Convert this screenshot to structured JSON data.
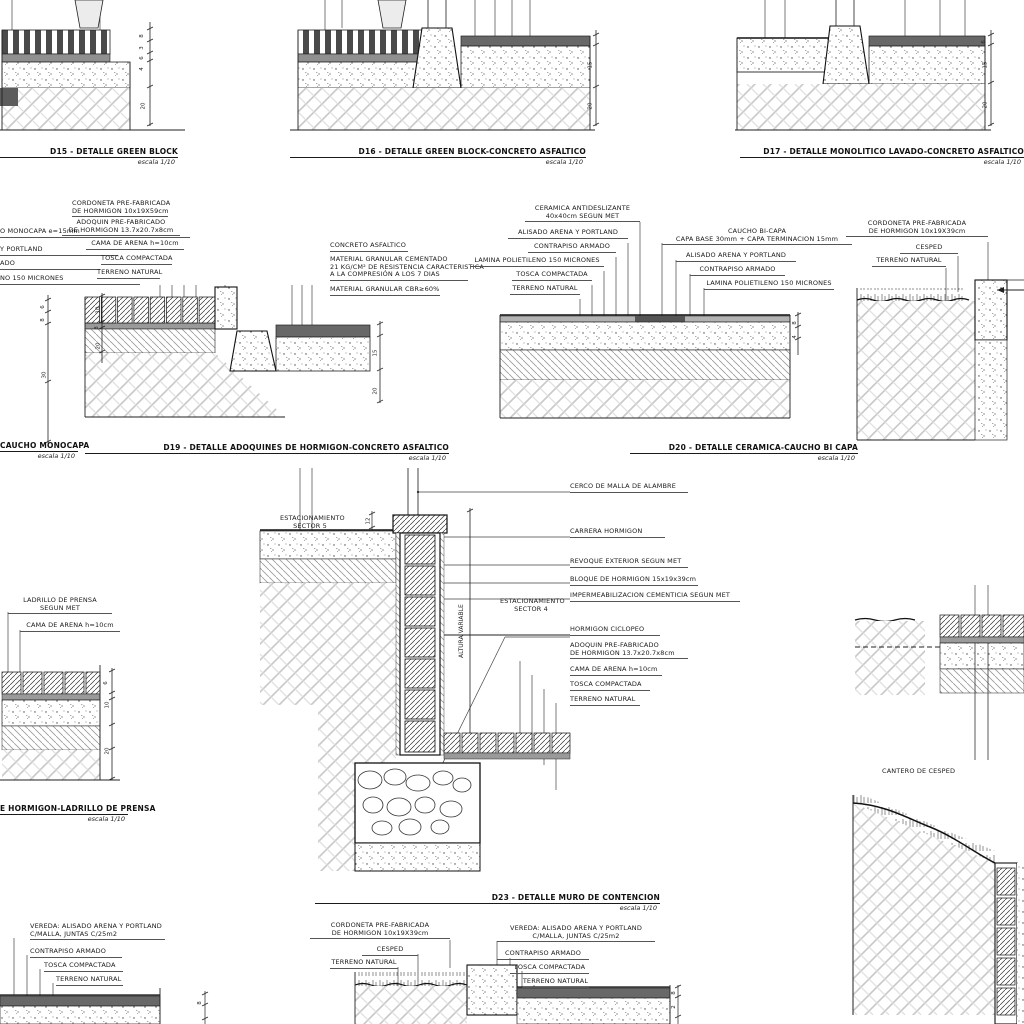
{
  "sheet": {
    "background": "#ffffff",
    "ink": "#1a1a1a"
  },
  "titles": {
    "d15": {
      "label": "D15 - DETALLE GREEN BLOCK",
      "scale": "escala 1/10"
    },
    "d16": {
      "label": "D16 - DETALLE GREEN BLOCK-CONCRETO ASFALTICO",
      "scale": "escala 1/10"
    },
    "d17": {
      "label": "D17 - DETALLE MONOLITICO LAVADO-CONCRETO ASFALTICO",
      "scale": "escala 1/10"
    },
    "d18_fragment": {
      "label": "CAUCHO MONOCAPA",
      "scale": "escala 1/10"
    },
    "d19": {
      "label": "D19 - DETALLE ADOQUINES DE HORMIGON-CONCRETO ASFALTICO",
      "scale": "escala 1/10"
    },
    "d20": {
      "label": "D20 - DETALLE CERAMICA-CAUCHO BI CAPA",
      "scale": "escala 1/10"
    },
    "d21_fragment": {
      "label": "E HORMIGON-LADRILLO DE PRENSA",
      "scale": "escala 1/10"
    },
    "d23": {
      "label": "D23 - DETALLE MURO DE CONTENCION",
      "scale": "escala 1/10"
    }
  },
  "d18": {
    "l1": "O MONOCAPA e=15mm",
    "l2": "Y PORTLAND",
    "l3": "ADO",
    "l4": "NO 150 MICRONES",
    "dim1": "6",
    "dim2": "8",
    "dim3": "30"
  },
  "d19": {
    "cordoneta1": "CORDONETA PRE-FABRICADA",
    "cordoneta2": "DE HORMIGON 10x19X59cm",
    "adoquin1": "ADOQUIN PRE-FABRICADO",
    "adoquin2": "DE HORMIGON 13.7x20.7x8cm",
    "cama": "CAMA DE ARENA h=10cm",
    "tosca": "TOSCA COMPACTADA",
    "terreno": "TERRENO NATURAL",
    "concreto": "CONCRETO ASFALTICO",
    "granular1": "MATERIAL GRANULAR CEMENTADO",
    "granular2": "21 KG/CM² DE RESISTENCIA CARACTERISTICA",
    "granular3": "A LA COMPRESIÓN A LOS 7 DIAS",
    "granular4": "MATERIAL GRANULAR CBR≥60%",
    "dimL1": "10",
    "dimL2": "8",
    "dimL3": "20",
    "dimR1": "15",
    "dimR2": "20"
  },
  "d20": {
    "ceramica1": "CERAMICA ANTIDESLIZANTE",
    "ceramica2": "40x40cm SEGUN MET",
    "alisado_izq": "ALISADO ARENA Y PORTLAND",
    "contrapiso_izq": "CONTRAPISO ARMADO",
    "lamina_izq": "LAMINA POLIETILENO 150 MICRONES",
    "tosca": "TOSCA COMPACTADA",
    "terreno": "TERRENO NATURAL",
    "caucho1": "CAUCHO BI-CAPA",
    "caucho2": "CAPA BASE 30mm + CAPA TERMINACION 15mm",
    "alisado_der": "ALISADO ARENA Y PORTLAND",
    "contrapiso_der": "CONTRAPISO ARMADO",
    "lamina_der": "LAMINA POLIETILENO 150 MICRONES",
    "dim1": "8",
    "dim2": "4"
  },
  "borde": {
    "cordoneta1": "CORDONETA PRE-FABRICADA",
    "cordoneta2": "DE HORMIGON 10x19X39cm",
    "cesped": "CESPED",
    "terreno": "TERRENO NATURAL"
  },
  "d23": {
    "sector5a": "ESTACIONAMIENTO",
    "sector5b": "SECTOR 5",
    "cerco": "CERCO DE MALLA DE ALAMBRE",
    "carrera": "CARRERA HORMIGON",
    "revoque": "REVOQUE EXTERIOR SEGUN MET",
    "bloque": "BLOQUE DE HORMIGON 15x19x39cm",
    "imper": "IMPERMEABILIZACION CEMENTICIA SEGUN MET",
    "sector4a": "ESTACIONAMIENTO",
    "sector4b": "SECTOR 4",
    "ciclopeo": "HORMIGON CICLOPEO",
    "adoquin1": "ADOQUIN PRE-FABRICADO",
    "adoquin2": "DE HORMIGON 13.7x20.7x8cm",
    "cama": "CAMA DE ARENA h=10cm",
    "tosca": "TOSCA COMPACTADA",
    "terreno": "TERRENO NATURAL",
    "altura": "ALTURA VARIABLE",
    "dim1": "12"
  },
  "d21": {
    "ladrillo1": "LADRILLO DE PRENSA",
    "ladrillo2": "SEGUN MET",
    "cama": "CAMA DE ARENA h=10cm",
    "dim1": "6",
    "dim2": "10",
    "dim3": "20"
  },
  "cantero": {
    "label": "CANTERO DE CESPED"
  },
  "vereda_centro": {
    "cordoneta1": "CORDONETA PRE-FABRICADA",
    "cordoneta2": "DE HORMIGON 10x19X39cm",
    "cesped": "CESPED",
    "terreno": "TERRENO NATURAL",
    "vereda1": "VEREDA: ALISADO ARENA Y PORTLAND",
    "vereda2": "C/MALLA, JUNTAS C/25m2",
    "contrapiso": "CONTRAPISO ARMADO",
    "tosca": "TOSCA COMPACTADA",
    "terreno2": "TERRENO NATURAL",
    "dim1": "8",
    "dim2": "2"
  },
  "vereda_izq": {
    "vereda1": "VEREDA: ALISADO ARENA Y PORTLAND",
    "vereda2": "C/MALLA, JUNTAS C/25m2",
    "contrapiso": "CONTRAPISO ARMADO",
    "tosca": "TOSCA COMPACTADA",
    "terreno": "TERRENO NATURAL",
    "dim1": "8"
  },
  "d15_dims": {
    "dim1": "8",
    "dim2": "3",
    "dim3": "6",
    "dim4": "4",
    "dim5": "20"
  },
  "d16_dims": {
    "dim1": "15",
    "dim2": "20"
  },
  "d17_dims": {
    "dim1": "6",
    "dim2": "15",
    "dim3": "20"
  }
}
